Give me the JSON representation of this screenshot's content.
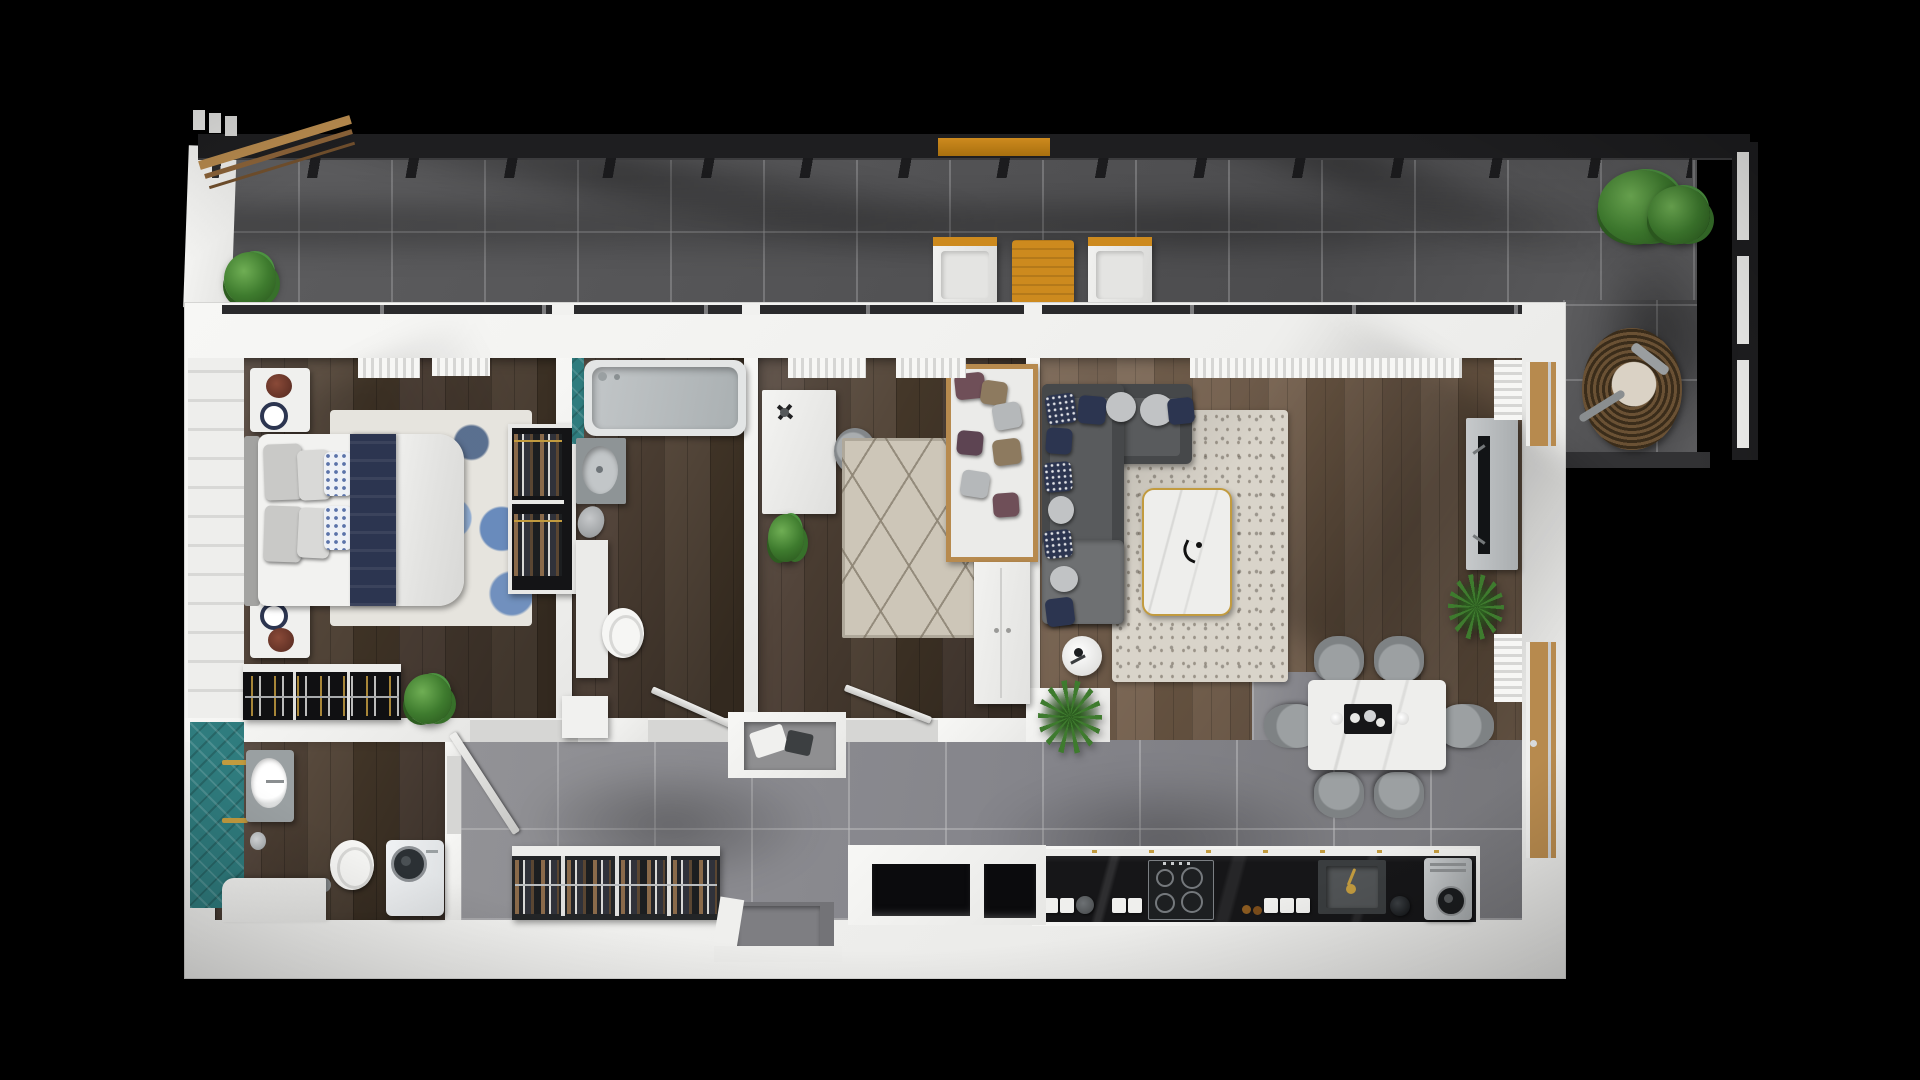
{
  "scene": {
    "kind": "3d-floor-plan-render",
    "view": "top-down",
    "background": "black",
    "width_px": 1920,
    "height_px": 1080
  },
  "palette": {
    "bg": "#000000",
    "wall": "#f1f1ef",
    "balc-a": "#5d5d5f",
    "balc-b": "#535355",
    "tile-a": "#929296",
    "tile-b": "#84848a",
    "wood-a": "#52443a",
    "wood-b": "#493c31",
    "lwood-a": "#74604e",
    "lwood-b": "#6a5746",
    "teal": "#2f7c7e",
    "navy": "#2c3550",
    "gray-pillow": "#c1c3c5",
    "sofa": "#46484a",
    "sofa-seat": "#595b5d",
    "chaise": "#6e7072",
    "rug-living": "#d9d4ca",
    "rug-bed2": "#cdc6b8",
    "marble": "#eeeeec",
    "gold": "#c29b3f",
    "counter": "#161618",
    "steel": "#c6c9cb",
    "green": "#3e7b2e",
    "green-dark": "#2d5d20",
    "accent-wood": "#b78a4e",
    "orange-wood": "#cd8a1e",
    "wicker": "#6a5134",
    "duvet": "#ebebe9",
    "rail-dark": "#1e1e20",
    "chair": "#7e8284",
    "washer-door": "#2b3034",
    "tv": "#121416"
  },
  "balcony": {
    "label": "Balcony terrace",
    "items": [
      "tiled-floor",
      "black-railing",
      "pergola-beams",
      "privacy-panel",
      "potted-shrub",
      "lounge-chair",
      "timber-side-table",
      "lounge-chair",
      "rail-shelf",
      "potted-tree",
      "wicker-egg-chair"
    ]
  },
  "rooms": {
    "master_bedroom": {
      "label": "Master bedroom",
      "items": [
        "double-bed",
        "navy-runner",
        "pillows",
        "headboard",
        "nightstand-top",
        "nightstand-bottom",
        "blue-area-rug",
        "open-wardrobe",
        "low-dresser",
        "potted-plant",
        "panelled-wall",
        "window-curtains",
        "door-leaf"
      ]
    },
    "family_bathroom": {
      "label": "Family bathroom",
      "items": [
        "bathtub",
        "vanity-sink",
        "storage-cabinet",
        "toilet",
        "teal-accent",
        "open-door"
      ]
    },
    "second_bedroom": {
      "label": "Second bedroom study",
      "items": [
        "desk",
        "desk-fan",
        "task-chair",
        "diamond-rug",
        "daybed-sofa",
        "scatter-cushions",
        "potted-plant",
        "wardrobe",
        "window-curtains",
        "open-door"
      ]
    },
    "living_room": {
      "label": "Open-plan living room",
      "items": [
        "corner-sofa",
        "scatter-cushions",
        "speckled-rug",
        "marble-coffee-table",
        "round-side-table",
        "tv-console",
        "television",
        "palm-plant",
        "window-curtains",
        "balcony-doors"
      ]
    },
    "dining_area": {
      "label": "Dining area",
      "items": [
        "marble-dining-table",
        "six-dining-chairs",
        "serving-tray",
        "palm-plant"
      ]
    },
    "kitchen": {
      "label": "Kitchen",
      "items": [
        "black-marble-counter",
        "induction-hob",
        "granite-sink",
        "gold-faucet",
        "coffee-machine",
        "canisters",
        "kettle",
        "round-jar"
      ]
    },
    "hallway": {
      "label": "Entrance hallway",
      "items": [
        "tiled-floor",
        "open-coat-closet",
        "storage-niches",
        "entry-bench",
        "front-door-recess"
      ]
    },
    "wc_bathroom": {
      "label": "Utility bathroom",
      "items": [
        "teal-accent",
        "vanity-sink",
        "toilet",
        "washing-machine",
        "corner-counter",
        "gold-towel-bars"
      ]
    }
  }
}
